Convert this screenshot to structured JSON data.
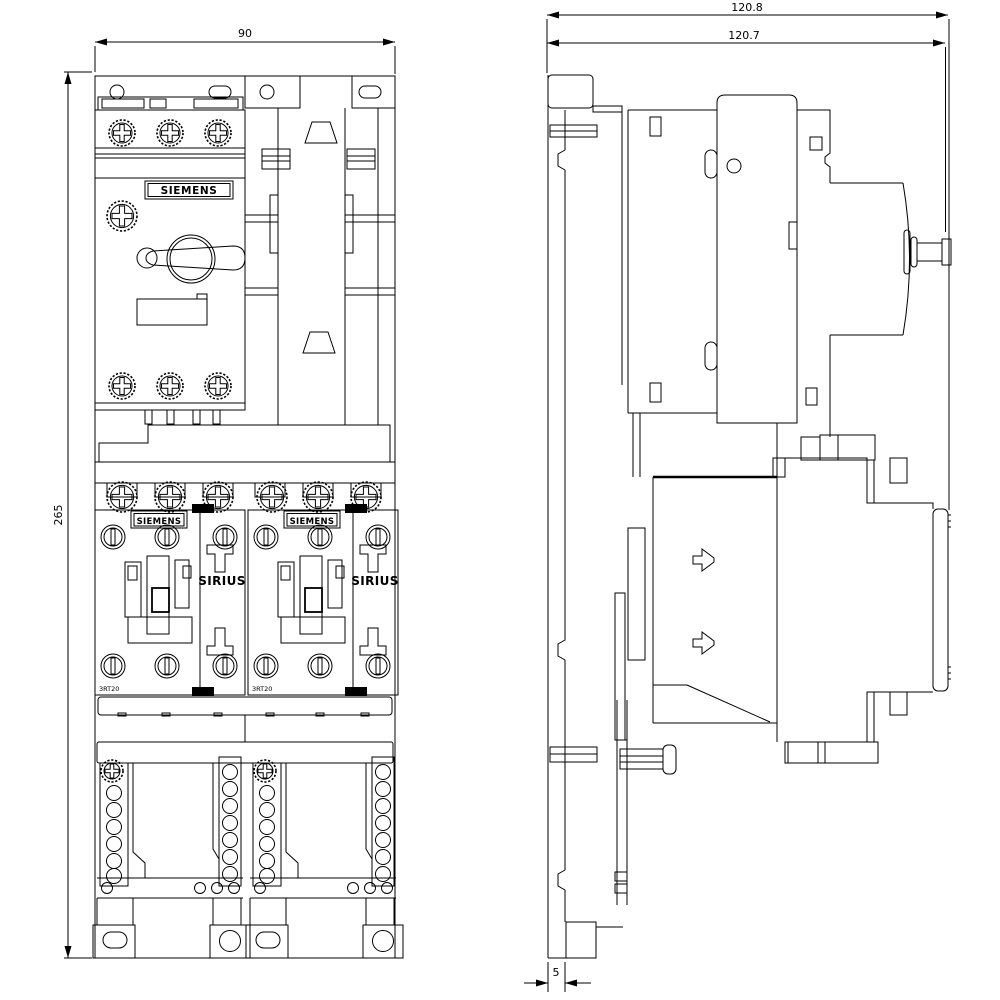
{
  "page": {
    "background": "#ffffff",
    "line_color": "#000000",
    "description": "Siemens SIRIUS reversing starter dimensional drawing, front view and side view"
  },
  "front_view": {
    "dim_width_mm": "90",
    "dim_height_mm": "265",
    "breaker": {
      "brand": "SIEMENS"
    },
    "contactor": {
      "brand": "SIEMENS",
      "series": "SIRIUS",
      "model": "3RT20"
    }
  },
  "side_view": {
    "dim_depth_overall_mm": "120.8",
    "dim_depth_device_mm": "120.7",
    "dim_plate_thickness_mm": "5"
  }
}
